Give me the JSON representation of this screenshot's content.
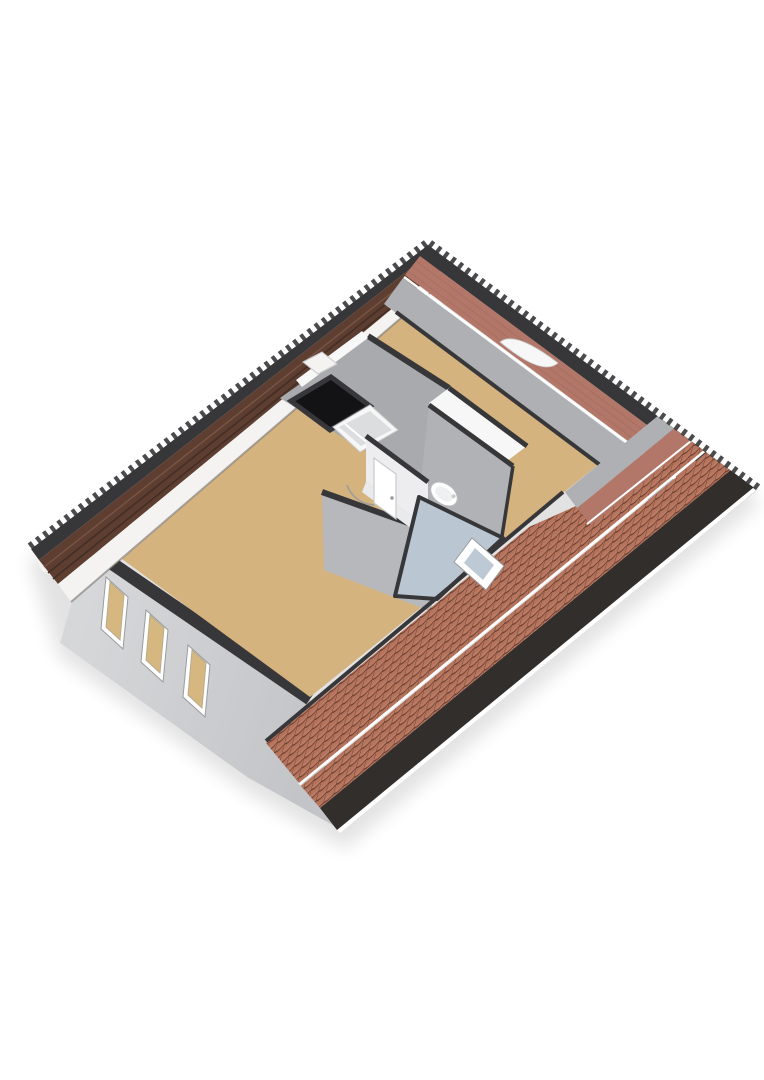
{
  "scene": {
    "kind": "3d-floorplan-render",
    "view": "isometric-overhead",
    "level": "attic",
    "areas": [
      "open-room-left",
      "open-room-right",
      "stair-landing",
      "bathroom"
    ],
    "fixtures": [
      "stairwell-opening",
      "staircase",
      "wash-basin",
      "bathroom-door",
      "door-swing-arc"
    ],
    "windows": {
      "gable_windows": 3,
      "roof_windows": 3
    }
  },
  "colors": {
    "background": "#ffffff",
    "white": "#ffffff",
    "edge_dark": "#37373a",
    "eave_dark": "#322e2c",
    "tile_base": "#b5735c",
    "tile_dark": "#6b4032",
    "tile_light": "#c68e77",
    "roof_inner_salmon": "#b27768",
    "salmon_line": "#9e6a5c",
    "roof_inner_brown": "#5d3e31",
    "brown_seam": "#442e25",
    "brown_light": "#7c5847",
    "fascia": "#f4f3f1",
    "fascia_line": "#6e6862",
    "floor_tan": "#d4b37e",
    "knee_gray": "#aeb0b3",
    "slope_gray": "#a8aaad",
    "slope_gray2": "#b0b2b5",
    "wall_white": "#f7f7f8",
    "wall_white_dim": "#ededef",
    "landing_floor": "#e9eaeb",
    "ext_wall": "#c3c4c7",
    "ext_wall_light": "#d6d7d9",
    "core_wall": "#b7b8bb",
    "bath_floor": "#bac7d3",
    "skylight_glass": "#bdc9d4",
    "stair_hole": "#131315",
    "glass_tan": "#d6b77f",
    "frame_line": "#9a9b9d",
    "glass_line": "#b9ab8e",
    "tray_inner": "#dcdddf",
    "tray_line": "#c9cacc",
    "arc_line": "#9b9c9e",
    "sink_line": "#b9babc",
    "sink_inner": "#eef0f1",
    "shadow": "#000000"
  }
}
